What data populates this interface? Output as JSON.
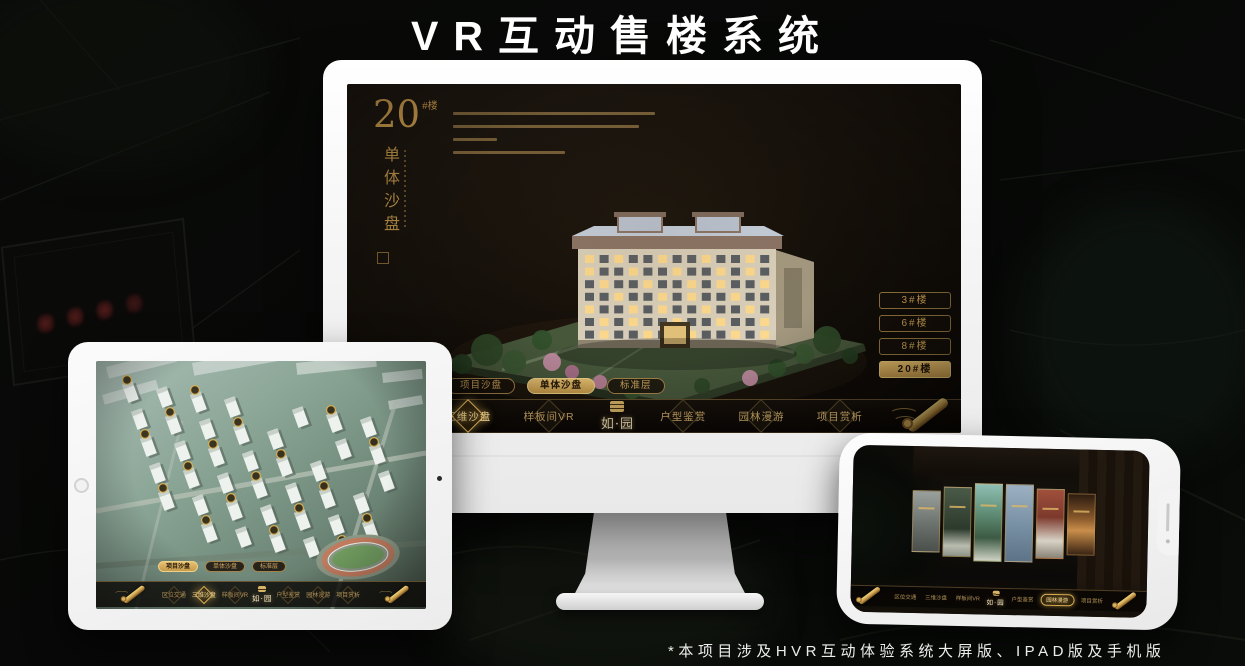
{
  "page": {
    "title": "VR互动售楼系统",
    "footnote": "*本项目涉及HVR互动体验系统大屏版、IPAD版及手机版"
  },
  "colors": {
    "gold": "#C9A35C",
    "gold_bright": "#E7C578",
    "screen_bg": "#16100A",
    "title_color": "#FFFFFF"
  },
  "shared_nav": {
    "logo": "如·园",
    "items": [
      "区位交通",
      "三维沙盘",
      "样板间VR",
      "户型鉴赏",
      "园林漫游",
      "项目赏析"
    ],
    "sub_tabs": [
      "项目沙盘",
      "单体沙盘",
      "标准层"
    ]
  },
  "monitor": {
    "block_number": "20",
    "block_number_suffix": "#楼",
    "block_subtitle": "单体沙盘",
    "building_buttons": [
      "3#楼",
      "6#楼",
      "8#楼",
      "20#楼"
    ],
    "active_building_index": 3,
    "active_tab_index": 1,
    "active_nav_index": 1
  },
  "tablet": {
    "active_tab_index": 0,
    "active_nav_index": 1
  },
  "phone": {
    "active_nav_index": 4
  }
}
